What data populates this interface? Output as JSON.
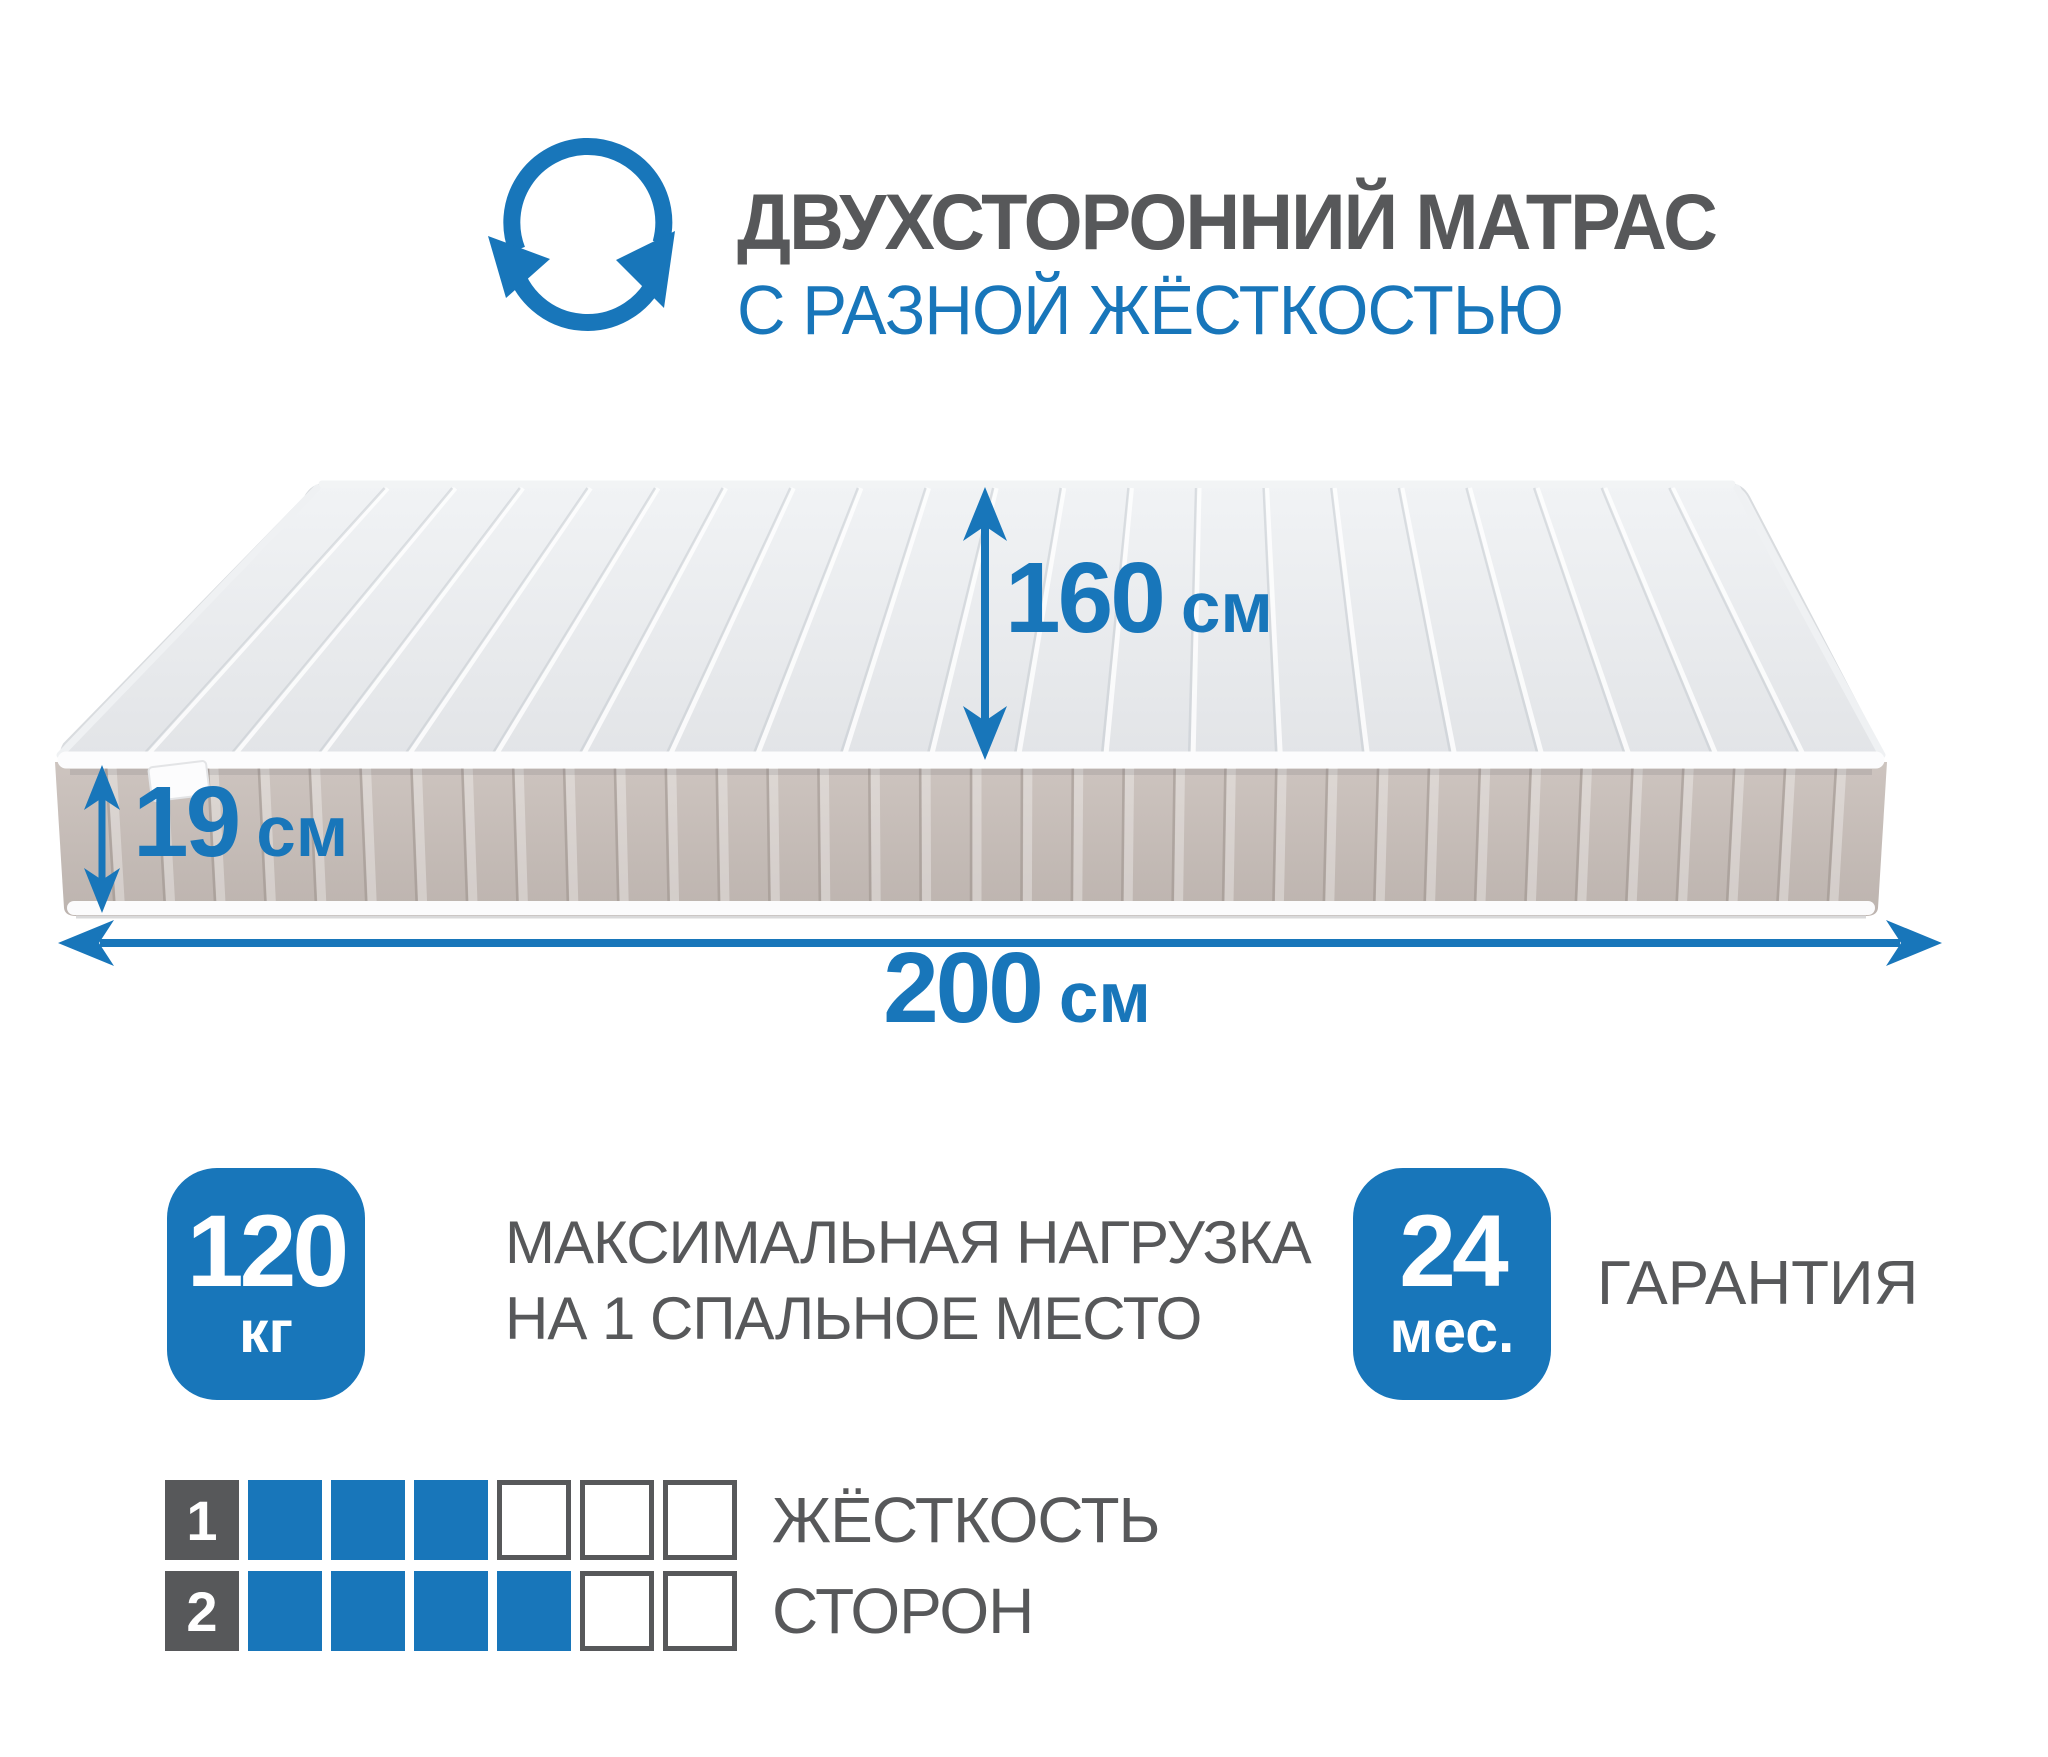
{
  "colors": {
    "blue": "#1876ba",
    "gray": "#57585a"
  },
  "header": {
    "icon": "rotate-arrows-icon",
    "title_line1": "ДВУХСТОРОННИЙ МАТРАС",
    "title_line2": "С РАЗНОЙ ЖЁСТКОСТЬЮ"
  },
  "dimensions": {
    "width": {
      "value": "160",
      "unit": "см"
    },
    "height": {
      "value": "19",
      "unit": "см"
    },
    "length": {
      "value": "200",
      "unit": "см"
    }
  },
  "badges": {
    "max_load": {
      "value": "120",
      "unit": "кг",
      "label_line1": "МАКСИМАЛЬНАЯ НАГРУЗКА",
      "label_line2": "НА 1 СПАЛЬНОЕ МЕСТО"
    },
    "warranty": {
      "value": "24",
      "unit": "мес.",
      "label": "ГАРАНТИЯ"
    }
  },
  "firmness": {
    "label_line1": "ЖЁСТКОСТЬ",
    "label_line2": "СТОРОН",
    "scale_max": 6,
    "sides": [
      {
        "number": "1",
        "value": 3
      },
      {
        "number": "2",
        "value": 4
      }
    ]
  }
}
